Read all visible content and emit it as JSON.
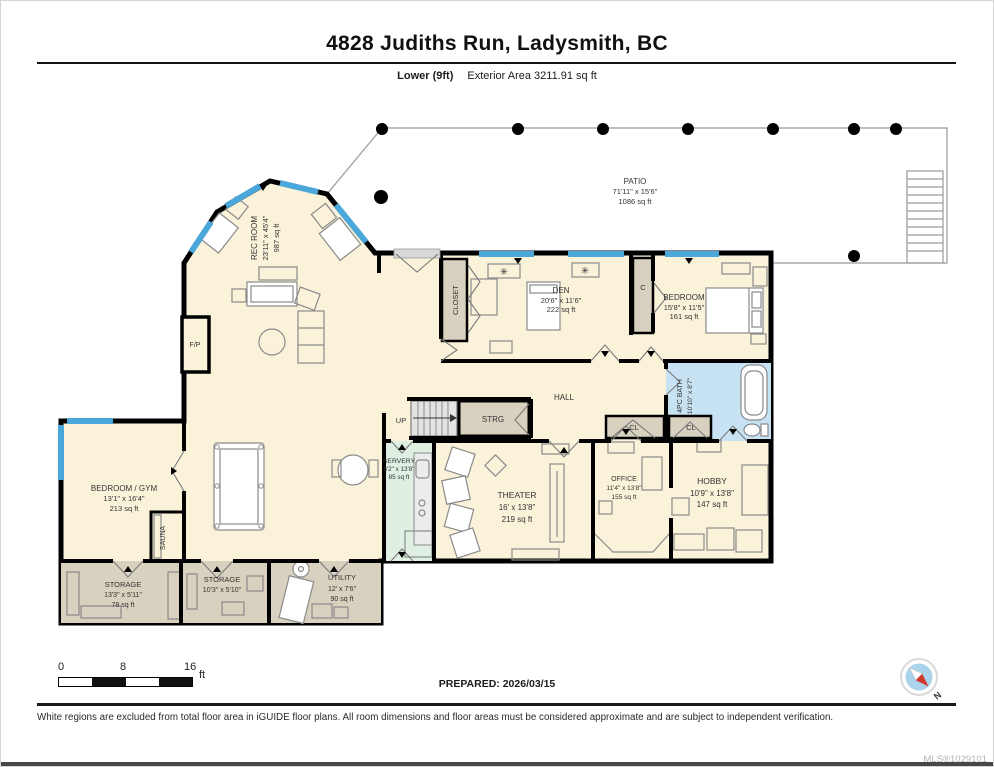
{
  "header": {
    "title": "4828 Judiths Run, Ladysmith, BC",
    "floor_label": "Lower (9ft)",
    "exterior_area": "Exterior Area 3211.91 sq ft"
  },
  "rooms": {
    "patio": {
      "name": "PATIO",
      "dims": "71'11\" x 15'6\"",
      "area": "1086 sq ft"
    },
    "rec_room": {
      "name": "REC ROOM",
      "dims": "23'11\" x 45'4\"",
      "area": "987 sq ft"
    },
    "den": {
      "name": "DEN",
      "dims": "20'6\" x 11'6\"",
      "area": "222 sq ft"
    },
    "bedroom": {
      "name": "BEDROOM",
      "dims": "15'8\" x 11'5\"",
      "area": "161 sq ft"
    },
    "bath": {
      "name": "4PC BATH",
      "dims": "10'10\" x 8'7\""
    },
    "bedroom_gym": {
      "name": "BEDROOM / GYM",
      "dims": "13'1\" x 16'4\"",
      "area": "213 sq ft"
    },
    "servery": {
      "name": "SERVERY",
      "dims": "6'2\" x 13'8\"",
      "area": "85 sq ft"
    },
    "theater": {
      "name": "THEATER",
      "dims": "16' x 13'8\"",
      "area": "219 sq ft"
    },
    "office": {
      "name": "OFFICE",
      "dims": "11'4\" x 13'8\"",
      "area": "155 sq ft"
    },
    "hobby": {
      "name": "HOBBY",
      "dims": "10'9\" x 13'8\"",
      "area": "147 sq ft"
    },
    "storage1": {
      "name": "STORAGE",
      "dims": "13'3\" x 5'11\"",
      "area": "78 sq ft"
    },
    "storage2": {
      "name": "STORAGE",
      "dims": "10'3\" x 5'10\""
    },
    "utility": {
      "name": "UTILITY",
      "dims": "12' x 7'6\"",
      "area": "90 sq ft"
    },
    "hall": {
      "name": "HALL"
    }
  },
  "labels": {
    "up": "UP",
    "strg": "STRG",
    "closet": "CLOSET",
    "c": "C",
    "cl": "CL",
    "sauna": "SAUNA",
    "fp": "F/P"
  },
  "icons": {
    "ceiling_light": "✳"
  },
  "scale_bar": {
    "t0": "0",
    "t8": "8",
    "t16": "16",
    "unit": "ft"
  },
  "prepared": "PREPARED: 2026/03/15",
  "compass": {
    "north": "N"
  },
  "footer": {
    "disclaimer": "White regions are excluded from total floor area in iGUIDE floor plans. All room dimensions and floor areas must be considered approximate and are subject to independent verification.",
    "mls": "MLS®1029101"
  },
  "colors": {
    "floor": "#FAF3DA",
    "closet_tan": "#D9D1BF",
    "bath_blue": "#C7E3F3",
    "servery_green": "#DFF0E3",
    "window_blue": "#4BA7D9",
    "wall": "#000000",
    "compass_red": "#D2372B",
    "compass_blue": "#ABD4EC"
  }
}
